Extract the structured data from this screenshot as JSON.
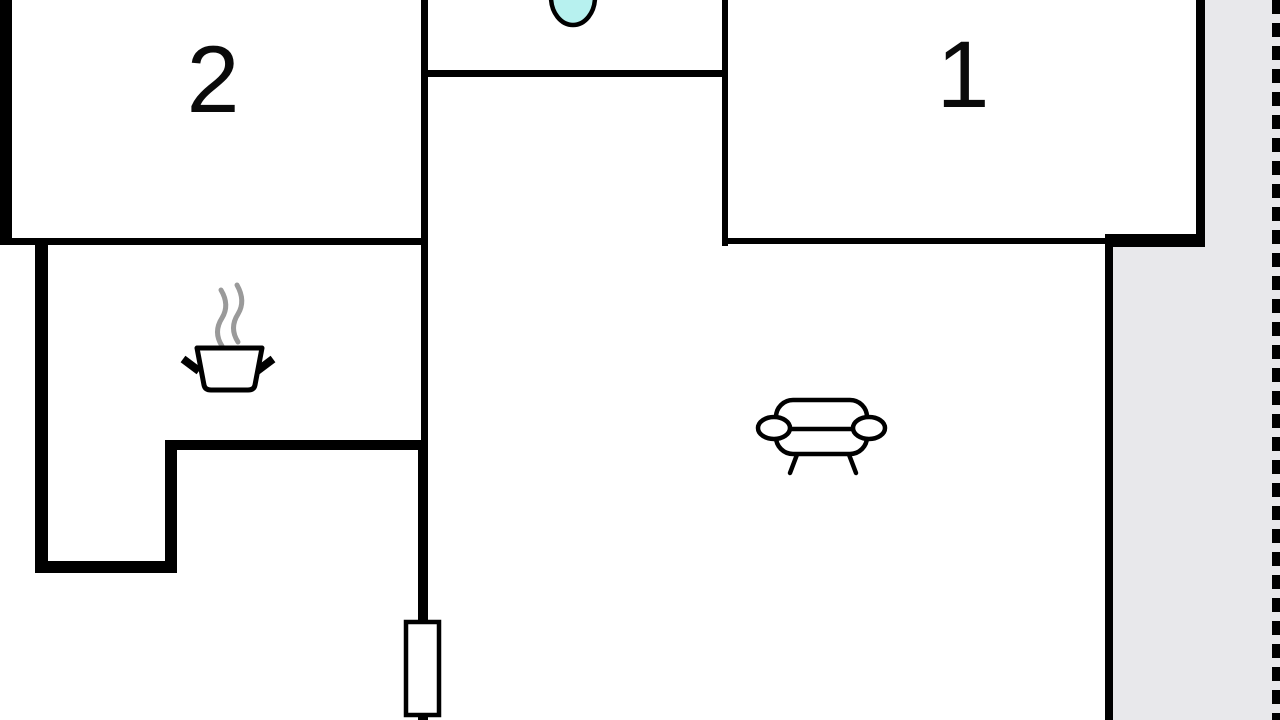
{
  "plan": {
    "title": "apartment-floor-plan",
    "rooms": [
      {
        "number": "2",
        "name": "bedroom-2"
      },
      {
        "number": "1",
        "name": "bedroom-1"
      }
    ],
    "icons": {
      "pot": "cooking-pot-icon",
      "steam": "steam-icon",
      "sofa": "sofa-icon",
      "basin": "water-basin-icon",
      "window": "window-symbol"
    },
    "colors": {
      "wall": "#000000",
      "floor": "#ffffff",
      "outdoor_area": "#e8e8eb",
      "water_fixture": "#b7f1ef",
      "steam": "#9a9a9a",
      "boundary": "#000000"
    }
  }
}
